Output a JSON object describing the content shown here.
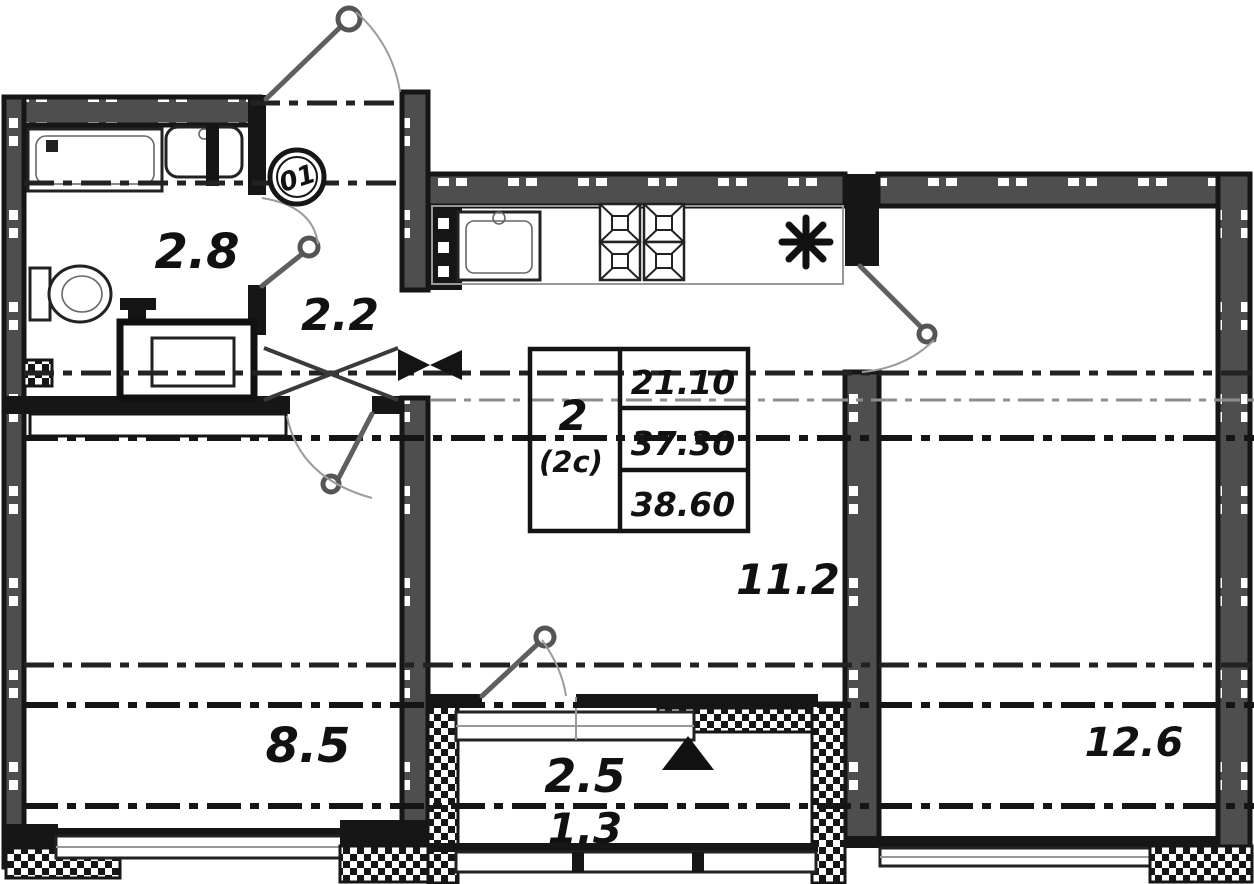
{
  "plan": {
    "entrance_badge": "01",
    "rooms": {
      "bathroom": "2.8",
      "hallway": "2.2",
      "kitchen_living": "11.2",
      "room_left": "8.5",
      "room_right": "12.6",
      "balcony": "2.5",
      "balcony_reduced": "1.3"
    },
    "stamp": {
      "type_line1": "2",
      "type_line2": "(2с)",
      "living_area": "21.10",
      "floor_area": "37.30",
      "total_area": "38.60"
    }
  }
}
